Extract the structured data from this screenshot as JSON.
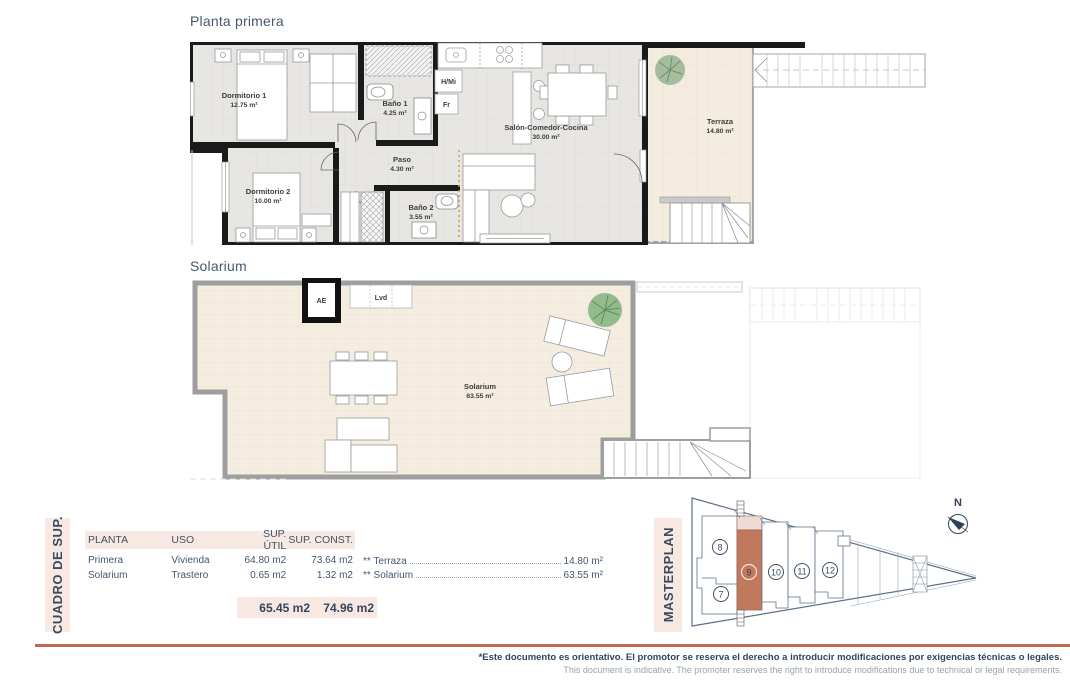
{
  "titles": {
    "plan1": "Planta primera",
    "plan2": "Solarium"
  },
  "plan1": {
    "rooms": [
      {
        "name": "Dormitorio 1",
        "area": "12.75 m²"
      },
      {
        "name": "Baño 1",
        "area": "4.25 m²"
      },
      {
        "name": "Paso",
        "area": "4.30 m²"
      },
      {
        "name": "Dormitorio 2",
        "area": "10.00 m²"
      },
      {
        "name": "Baño 2",
        "area": "3.55 m²"
      },
      {
        "name": "Salón-Comedor-Cocina",
        "area": "30.00 m²"
      },
      {
        "name": "Terraza",
        "area": "14.80 m²"
      }
    ],
    "labels": {
      "hmi": "H/Mi",
      "fr": "Fr"
    }
  },
  "plan2": {
    "room": {
      "name": "Solarium",
      "area": "63.55 m²"
    },
    "labels": {
      "ae": "AE",
      "lvd": "Lvd"
    }
  },
  "summary": {
    "side_label": "CUADRO DE SUP.",
    "headers": [
      "PLANTA",
      "USO",
      "SUP. ÚTIL",
      "SUP. CONST."
    ],
    "rows": [
      {
        "planta": "Primera",
        "uso": "Vivienda",
        "util": "64.80 m2",
        "const": "73.64 m2"
      },
      {
        "planta": "Solarium",
        "uso": "Trastero",
        "util": "0.65 m2",
        "const": "1.32 m2"
      }
    ],
    "totals": {
      "util": "65.45 m2",
      "const": "74.96 m2"
    },
    "notes": [
      {
        "label": "** Terraza",
        "value": "14.80 m²"
      },
      {
        "label": "** Solarium",
        "value": "63.55 m²"
      }
    ]
  },
  "masterplan": {
    "side_label": "MASTERPLAN",
    "units": [
      "7",
      "8",
      "9",
      "10",
      "11",
      "12"
    ],
    "highlighted_unit": "9",
    "compass": "N"
  },
  "footer": {
    "line1": "*Este documento es orientativo. El promotor se reserva el derecho a introducir modificaciones por exigencias técnicas o legales.",
    "line2": "This document is indicative. The promoter reserves the right to introduce modifications due to technical or legal requirements."
  },
  "colors": {
    "accent": "#bd6c53",
    "panel_bg": "#f7e9e2",
    "navy": "#3a4b60",
    "highlight_unit": "#c1795e",
    "floor_gray": "#e7e6e3",
    "floor_beige": "#f3ecdf"
  }
}
